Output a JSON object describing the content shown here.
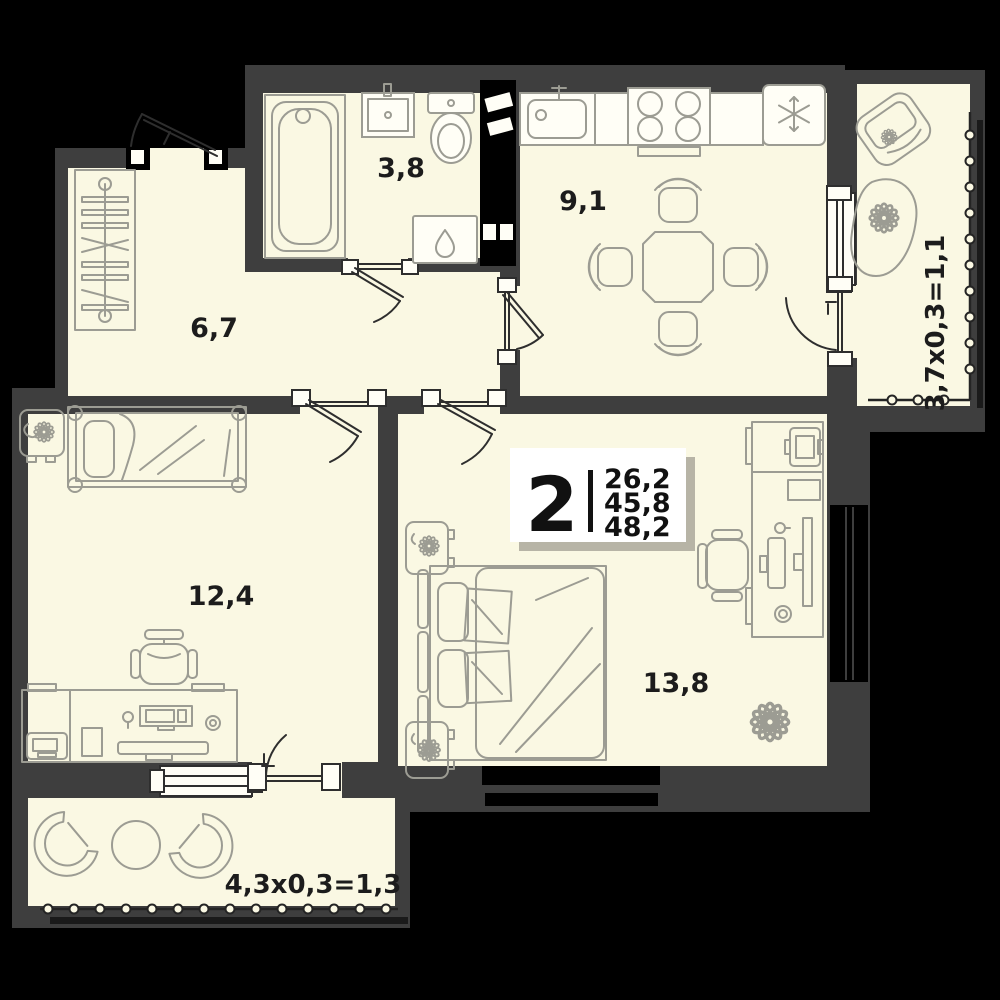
{
  "plan_type": "apartment-floor-plan",
  "palette": {
    "background": "#000000",
    "wall": "#3E3E3E",
    "floor": "#FAF8E3",
    "furniture_line": "#9C9C93",
    "door_line": "#2E2E2E",
    "label_text": "#1C1C1C",
    "card_background": "#FFFFFF",
    "card_shadow": "#B7B4A6"
  },
  "info_card": {
    "rooms_count": "2",
    "area_living": "26,2",
    "area_main": "45,8",
    "area_total": "48,2"
  },
  "rooms": {
    "bathroom": {
      "area_label": "3,8",
      "fixtures": [
        "bathtub",
        "sink",
        "toilet",
        "washing-machine"
      ]
    },
    "kitchen": {
      "area_label": "9,1",
      "fixtures": [
        "kitchen-sink",
        "stove",
        "fridge",
        "dining-table",
        "chairs"
      ]
    },
    "hallway": {
      "area_label": "6,7",
      "fixtures": [
        "wardrobe"
      ]
    },
    "bedroom": {
      "area_label": "12,4",
      "fixtures": [
        "single-bed",
        "nightstand-plant",
        "desk",
        "office-chair",
        "computer",
        "printer"
      ]
    },
    "living_room": {
      "area_label": "13,8",
      "fixtures": [
        "double-bed",
        "nightstand-plant",
        "nightstand-plant",
        "desk",
        "office-chair",
        "computer",
        "printer",
        "plant"
      ]
    },
    "balcony_right": {
      "area_label": "3,7x0,3=1,1",
      "fixtures": [
        "armchair",
        "planter"
      ]
    },
    "balcony_bottom": {
      "area_label": "4,3x0,3=1,3",
      "fixtures": [
        "chair",
        "round-table",
        "chair"
      ]
    }
  }
}
